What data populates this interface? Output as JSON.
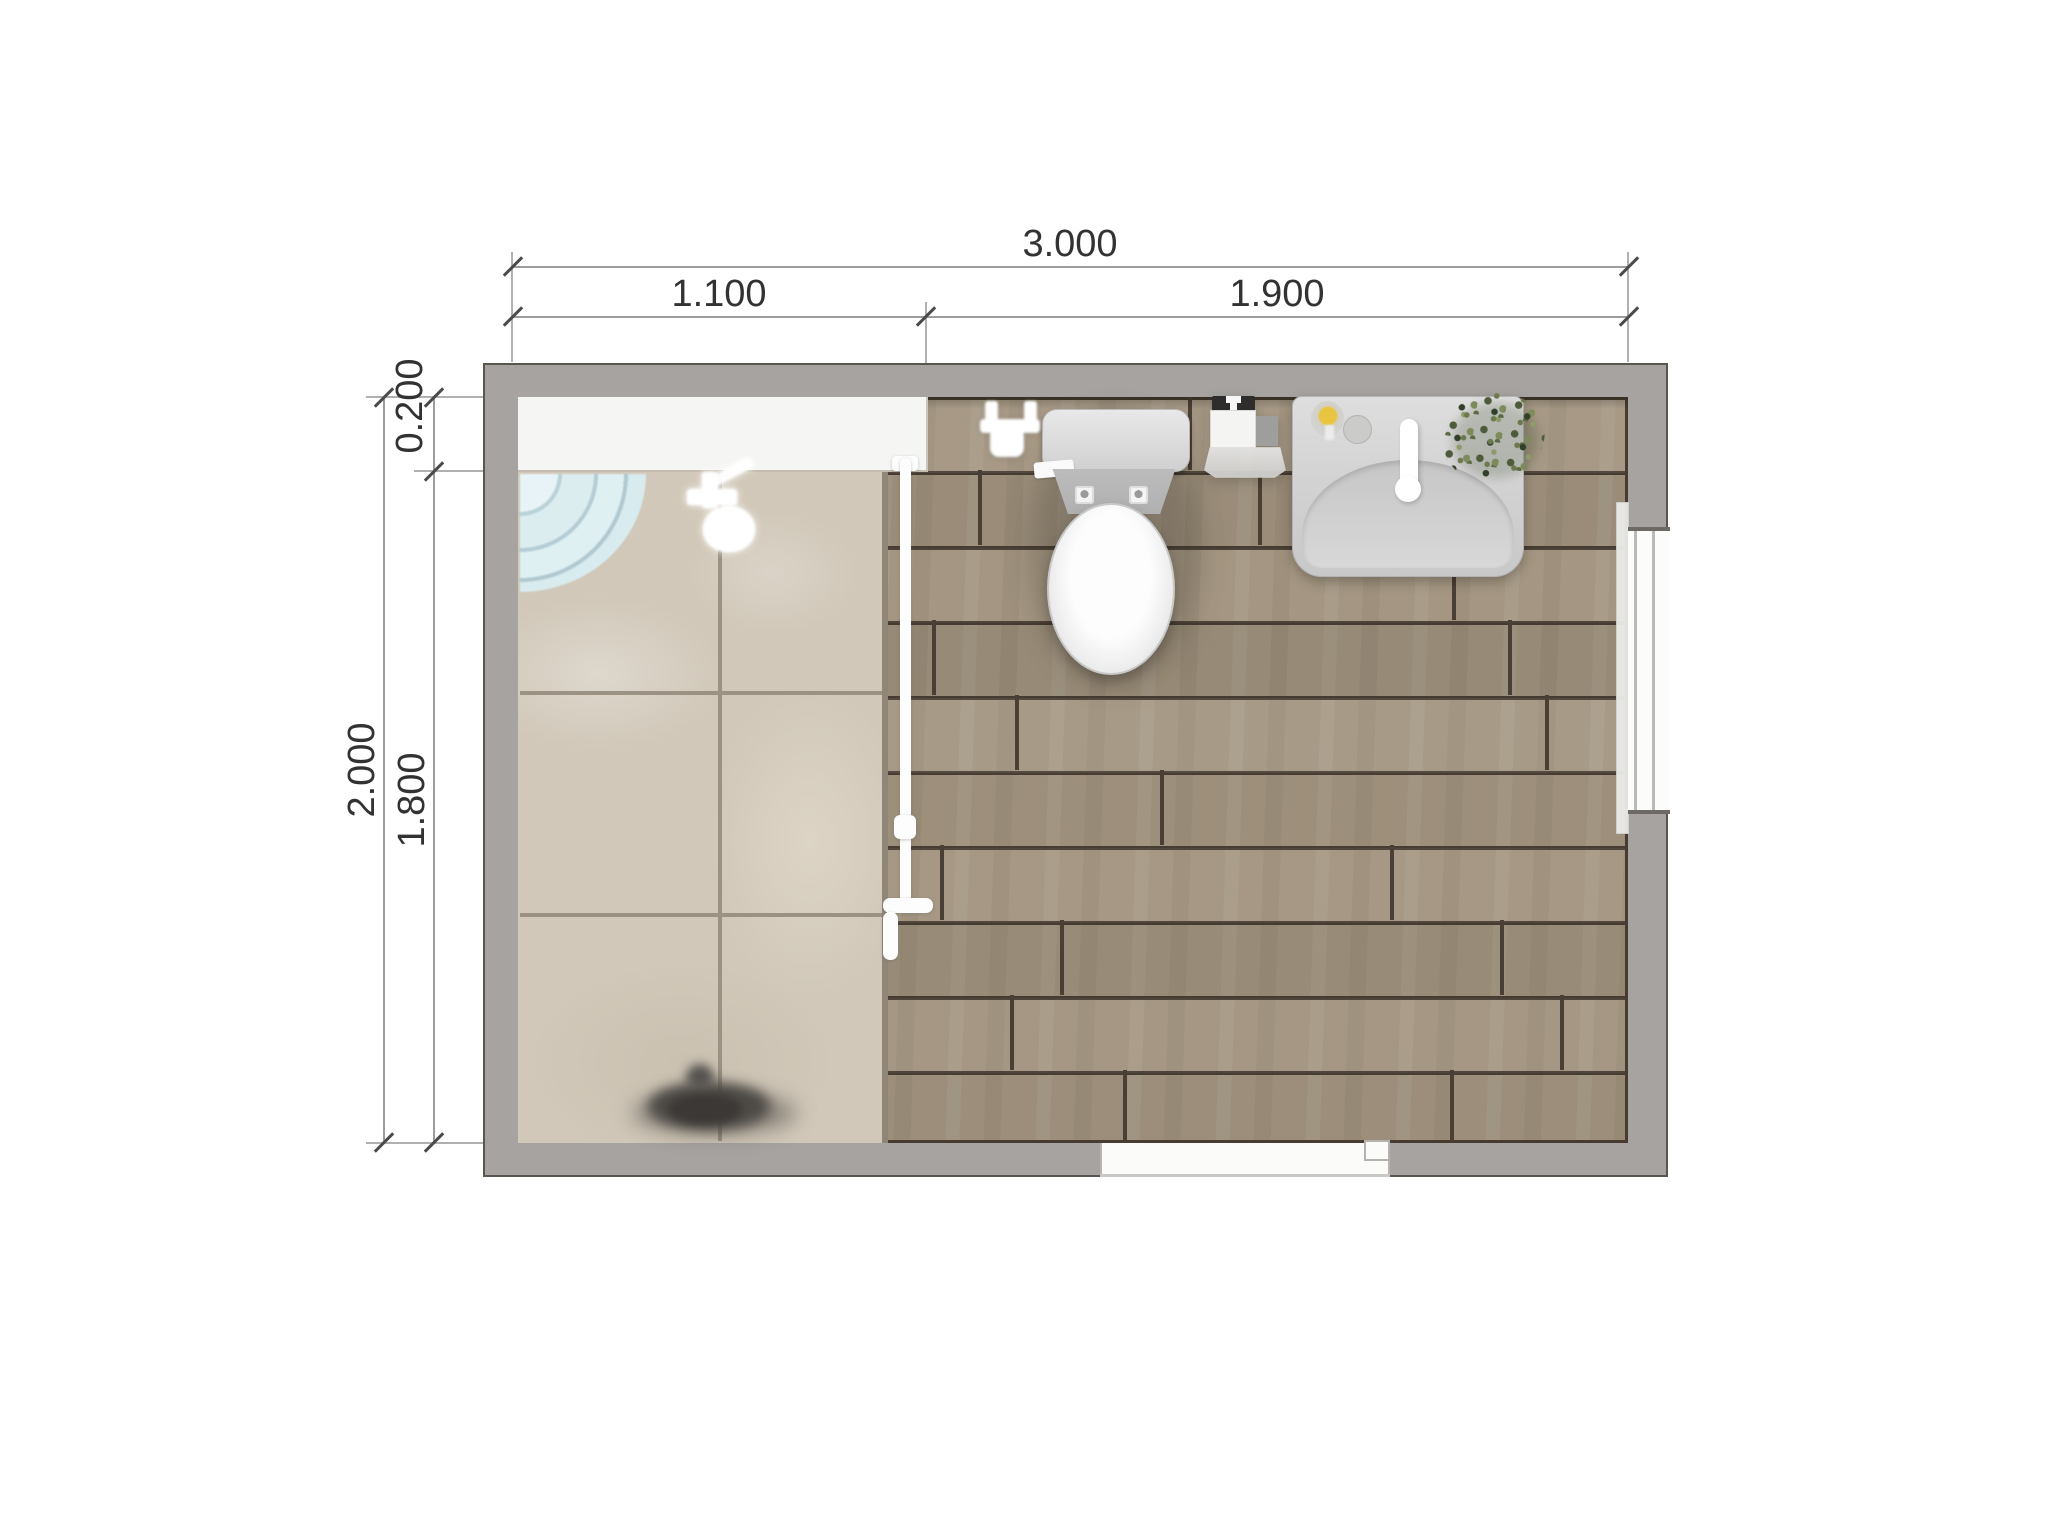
{
  "drawing": {
    "type": "bathroom-floor-plan-top-view",
    "units": "meters"
  },
  "dimensions": {
    "top": {
      "total": "3.000",
      "segment_left": "1.100",
      "segment_right": "1.900"
    },
    "left": {
      "total": "2.000",
      "segment_top": "0.200",
      "segment_bottom": "1.800"
    }
  },
  "fixtures": {
    "shower_area": "marble-tile-walk-in-shower",
    "shower_tray": "corner-quarter-round-tray",
    "shower_head": "shower-head",
    "glass_screen": "glass-partition-with-handle",
    "toilet": "toilet-with-cistern",
    "toilet_paper_holder": "toilet-paper-holder",
    "trash_bin": "pedal-waste-bin",
    "vanity": "washbasin-vanity-with-faucet",
    "soap_dispenser": "soap-dispenser",
    "plant": "potted-plant",
    "window": "window-right-wall",
    "door": "door-opening-bottom-wall",
    "floor_drain": "floor-drain"
  },
  "colors": {
    "wall": "#a6a3a0",
    "wood_floor": "#a2947f",
    "marble_tile": "#d1c8b9",
    "glass_blue": "#dcedf0",
    "plant_green": "#5f6f4a",
    "accent_yellow": "#e9c43e"
  }
}
